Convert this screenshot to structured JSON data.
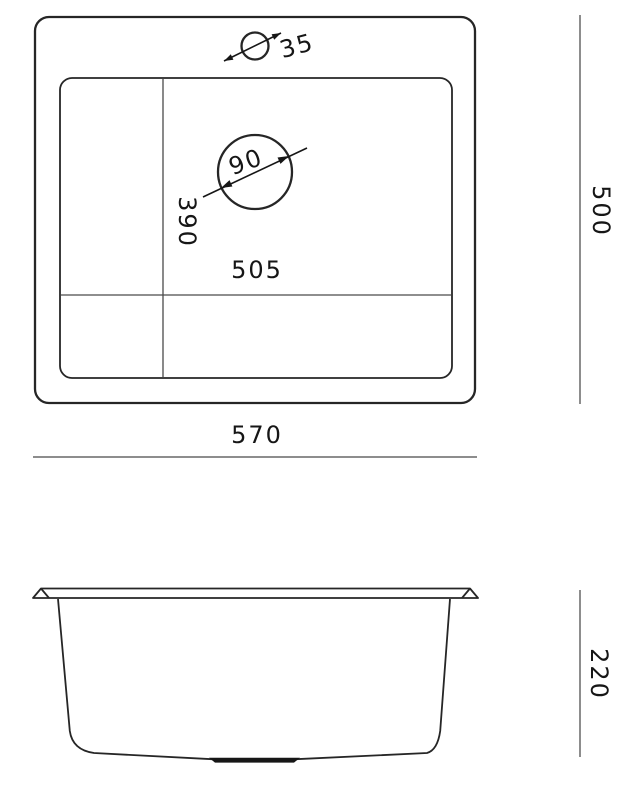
{
  "drawing": {
    "kind": "sink-technical-drawing",
    "top_view": {
      "faucet_hole_diameter": "35",
      "drain_diameter": "90",
      "bowl_interior_depth": "390",
      "bowl_interior_width": "505",
      "overall_width": "570",
      "overall_depth": "500"
    },
    "side_view": {
      "overall_height": "220"
    },
    "colors": {
      "outline": "#262626",
      "divider_line": "#4a4a4a",
      "dimension_line": "#8d8d8d",
      "text": "#161616",
      "background": "#ffffff"
    }
  }
}
